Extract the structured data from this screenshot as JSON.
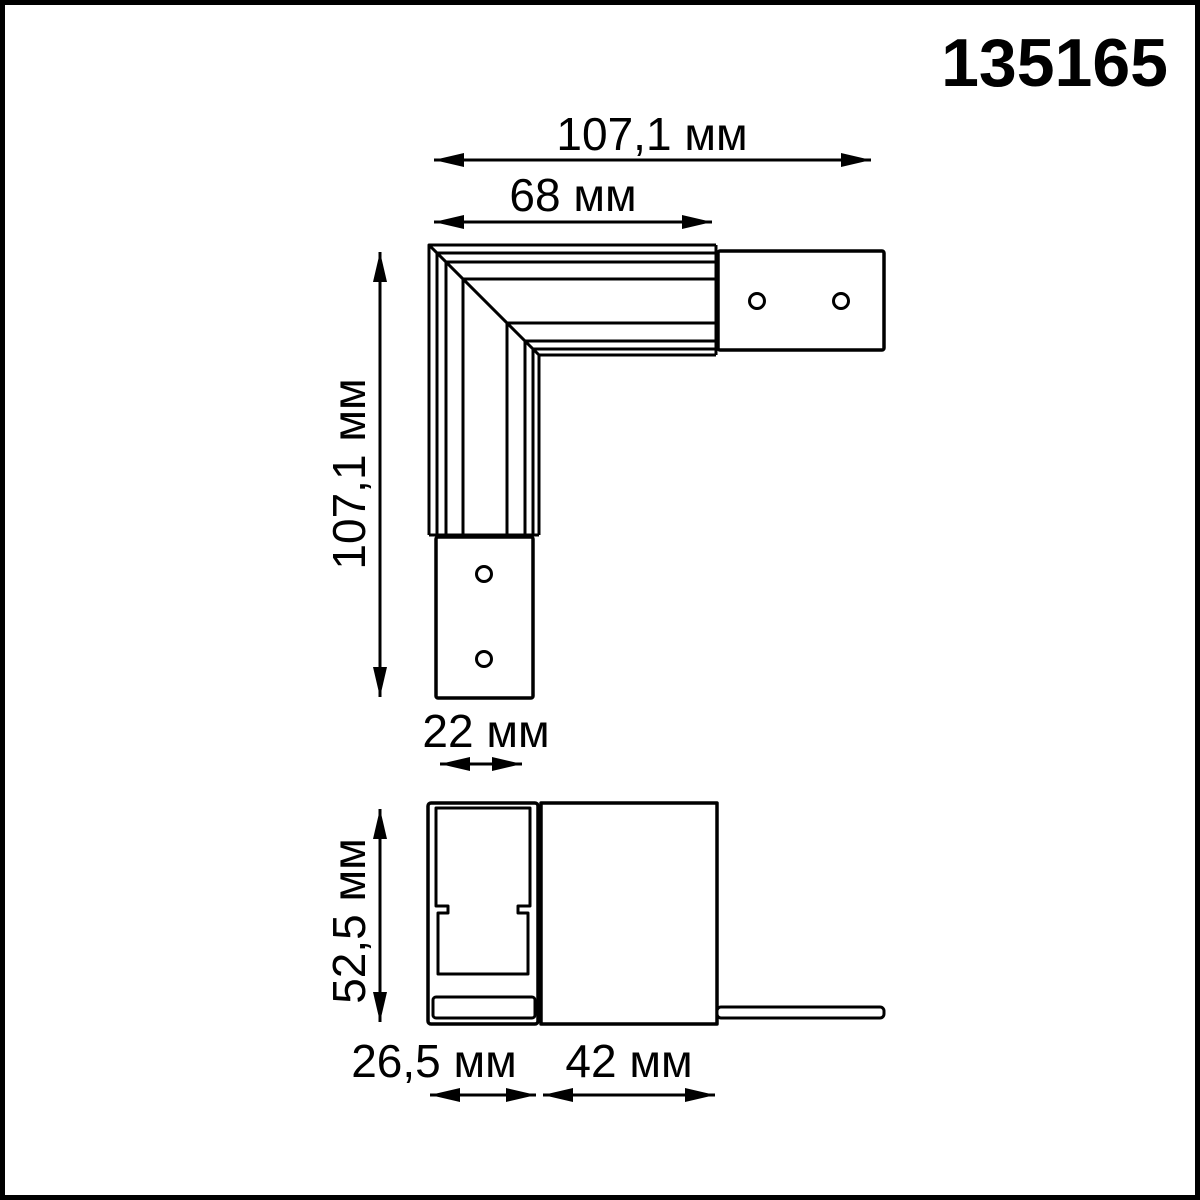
{
  "product_number": "135165",
  "top_view": {
    "dim_total_width": "107,1 мм",
    "dim_corner_arm_width": "68 мм",
    "dim_total_height": "107,1 мм",
    "dim_end_tab_width": "22 мм"
  },
  "section_view": {
    "dim_height": "52,5 мм",
    "dim_profile_width": "26,5 мм",
    "dim_body_width": "42 мм"
  },
  "colors": {
    "line": "#000000",
    "background": "#ffffff"
  }
}
